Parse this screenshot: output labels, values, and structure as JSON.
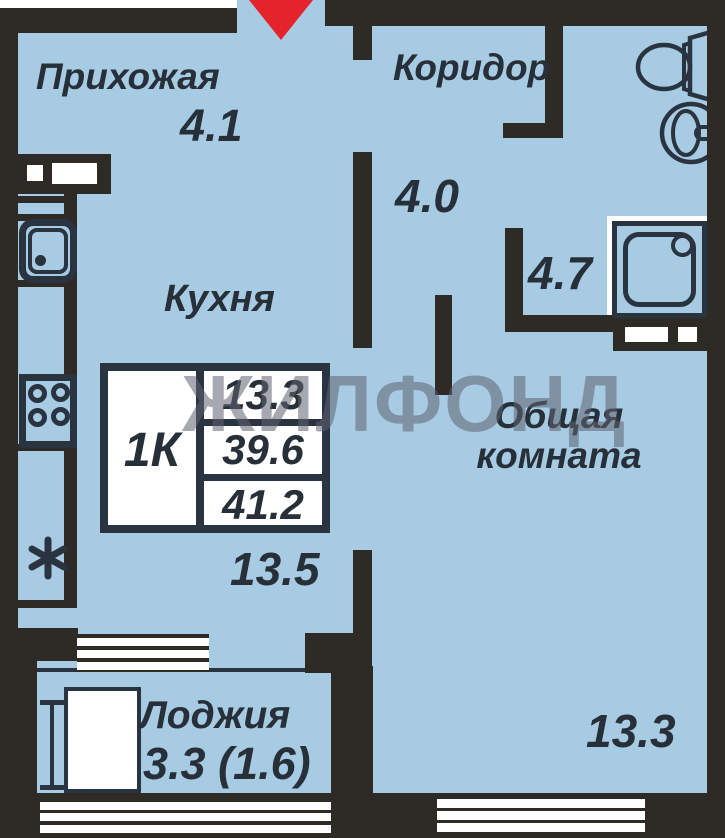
{
  "plan": {
    "watermark": "ЖИЛФОНД",
    "rooms": {
      "hallway": {
        "name": "Прихожая",
        "area": "4.1"
      },
      "corridor": {
        "name": "Коридор",
        "area": "4.0"
      },
      "kitchen": {
        "name": "Кухня",
        "area": "13.5"
      },
      "bathroom": {
        "area": "4.7"
      },
      "living_room": {
        "name_line1": "Общая",
        "name_line2": "комната",
        "area": "13.3"
      },
      "loggia": {
        "name": "Лоджия",
        "area": "3.3 (1.6)"
      }
    },
    "info_table": {
      "unit_type": "1К",
      "living_area": "13.3",
      "usable_area": "39.6",
      "total_area": "41.2"
    },
    "kitchen_note_symbol": "*",
    "colors": {
      "floor": "#a7cbe3",
      "wall": "#2e2a26",
      "ink": "#273039",
      "line": "#2a3340",
      "red": "#e4232b",
      "wm": "#5f6470",
      "white": "#ffffff"
    }
  }
}
